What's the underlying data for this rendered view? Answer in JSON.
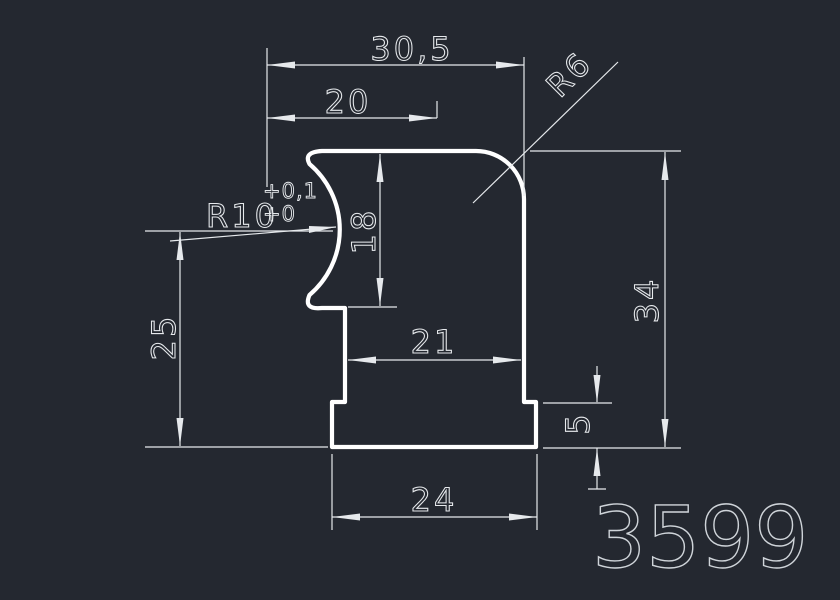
{
  "title": "CAD profile drawing 3599",
  "canvas": {
    "width": 840,
    "height": 600,
    "background_color": "#242830",
    "profile_line_color": "#ffffff",
    "dimension_line_color": "#e6e9ec",
    "dimension_text_color": "#e6e9ec",
    "part_number_color": "#cfd4d9"
  },
  "drawing": {
    "part_number": "3599",
    "dimensions": {
      "top_width": {
        "label": "30,5"
      },
      "upper_width": {
        "label": "20"
      },
      "corner_radius": {
        "label": "R6"
      },
      "groove_radius": {
        "label": "R10",
        "tol_upper": "+0,1",
        "tol_lower": "+0"
      },
      "groove_height": {
        "label": "18"
      },
      "left_height": {
        "label": "25"
      },
      "body_width": {
        "label": "21"
      },
      "total_height": {
        "label": "34"
      },
      "base_height": {
        "label": "5"
      },
      "base_width": {
        "label": "24"
      }
    }
  }
}
